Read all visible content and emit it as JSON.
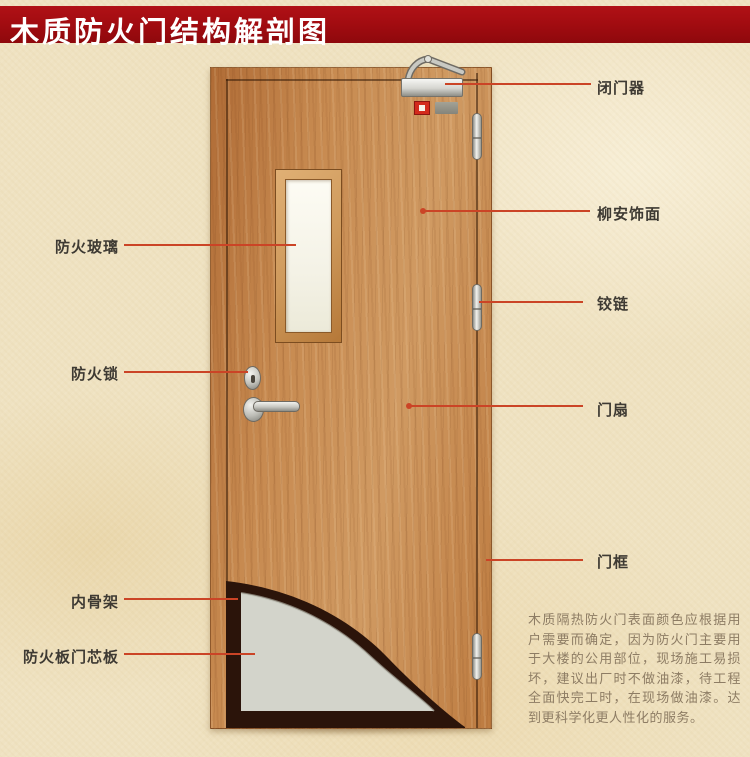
{
  "title": "木质防火门结构解剖图",
  "labels": {
    "door_closer": "闭门器",
    "lauan_veneer": "柳安饰面",
    "hinge": "铰链",
    "door_leaf": "门扇",
    "door_frame": "门框",
    "fire_glass": "防火玻璃",
    "fire_lock": "防火锁",
    "inner_skeleton": "内骨架",
    "fire_board_core": "防火板门芯板"
  },
  "description": "木质隔热防火门表面颜色应根据用户需要而确定，因为防火门主要用于大楼的公用部位，现场施工易损坏，建议出厂时不做油漆，待工程全面快完工时，在现场做油漆。达到更科学化更人性化的服务。",
  "colors": {
    "banner_red": "#a30c11",
    "leader_line": "#cb4426",
    "label_text": "#3e3a33",
    "wood": "#c78a50",
    "core_gray": "#d3d4cb",
    "skeleton_dark": "#2b140a",
    "background": "#efe2c1"
  }
}
